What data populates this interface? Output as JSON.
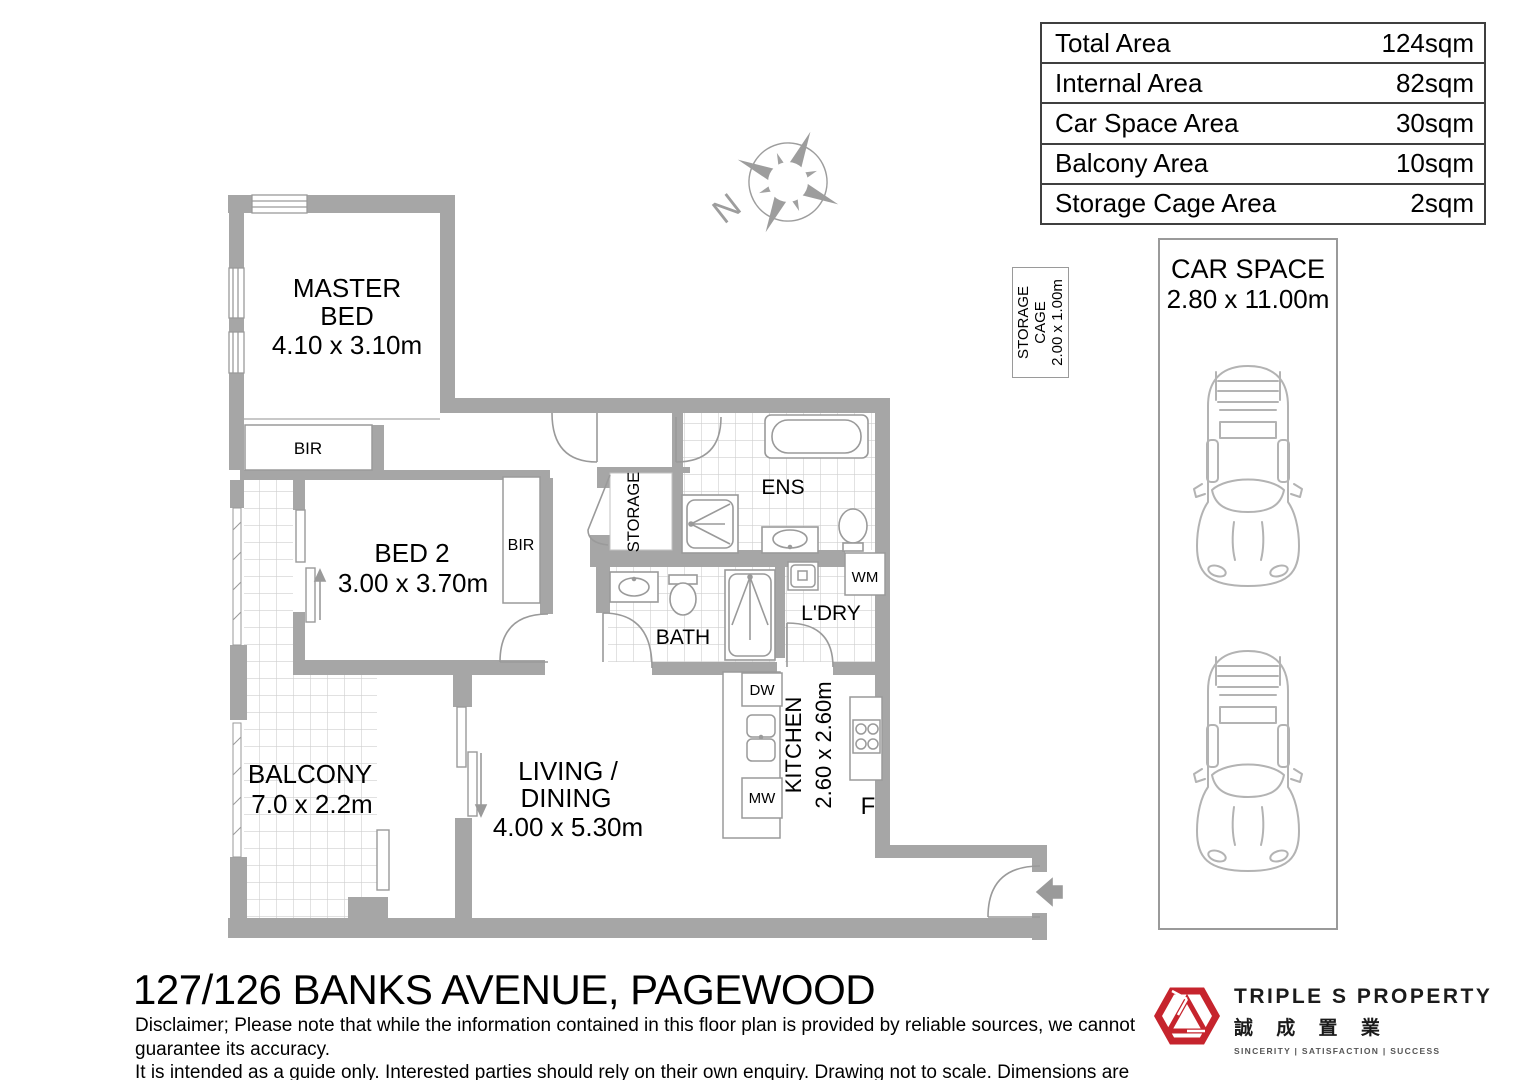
{
  "area_table": {
    "rows": [
      {
        "label": "Total Area",
        "value": "124sqm"
      },
      {
        "label": "Internal Area",
        "value": "82sqm"
      },
      {
        "label": "Car Space Area",
        "value": "30sqm"
      },
      {
        "label": "Balcony Area",
        "value": "10sqm"
      },
      {
        "label": "Storage Cage Area",
        "value": "2sqm"
      }
    ]
  },
  "compass": {
    "north": "N"
  },
  "storage_cage": {
    "line1": "STORAGE",
    "line2": "CAGE",
    "dims": "2.00 x 1.00m"
  },
  "car_space": {
    "title": "CAR SPACE",
    "dims": "2.80 x 11.00m"
  },
  "rooms": {
    "master_bed": {
      "name1": "MASTER",
      "name2": "BED",
      "dims": "4.10 x 3.10m"
    },
    "bed2": {
      "name": "BED 2",
      "dims": "3.00 x 3.70m"
    },
    "balcony": {
      "name": "BALCONY",
      "dims": "7.0 x 2.2m"
    },
    "living": {
      "name1": "LIVING /",
      "name2": "DINING",
      "dims": "4.00 x 5.30m"
    },
    "kitchen": {
      "name": "KITCHEN",
      "dims": "2.60 x 2.60m"
    },
    "ens": {
      "name": "ENS"
    },
    "bath": {
      "name": "BATH"
    },
    "laundry": {
      "name": "L'DRY"
    },
    "storage": {
      "name": "STORAGE"
    },
    "bir_master": "BIR",
    "bir_bed2": "BIR",
    "appliances": {
      "dw": "DW",
      "mw": "MW",
      "wm": "WM",
      "fridge": "F"
    }
  },
  "footer": {
    "address": "127/126 BANKS AVENUE, PAGEWOOD",
    "disclaimer1": "Disclaimer; Please note that while the information contained in this floor plan is provided by reliable sources, we cannot guarantee its accuracy.",
    "disclaimer2": "It is intended as a guide only. Interested parties should rely on their own enquiry. Drawing not to scale. Dimensions are approximate."
  },
  "logo": {
    "name": "TRIPLE S PROPERTY",
    "chinese": "誠 成 置 業",
    "tagline": "SINCERITY  |  SATISFACTION  |  SUCCESS"
  },
  "colors": {
    "wall": "#a6a6a6",
    "fixture": "#9a9a9a",
    "tile": "#cfcfcf",
    "brand_red": "#c6242d"
  }
}
